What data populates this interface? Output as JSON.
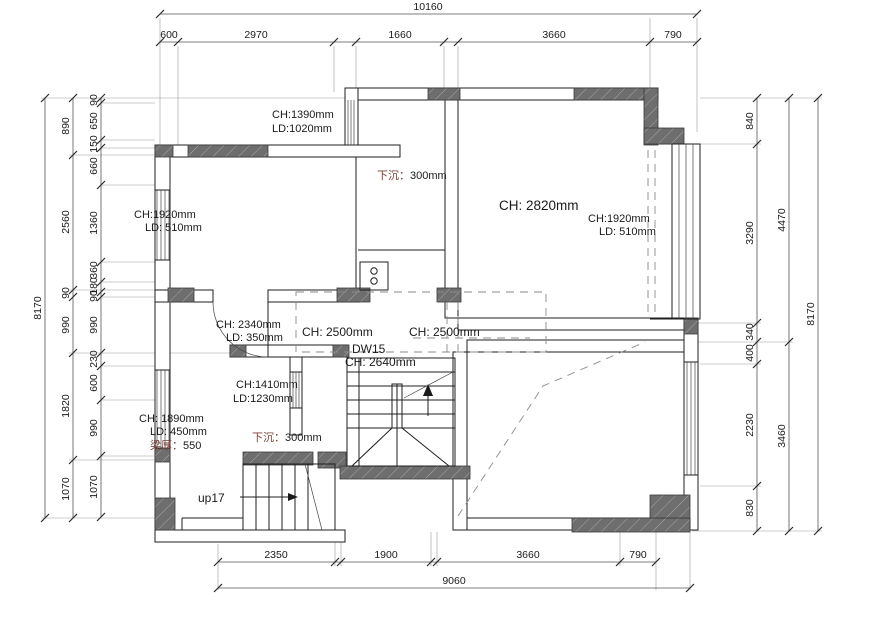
{
  "app": {
    "type": "cad-floor-plan",
    "background": "#ffffff",
    "line_color": "#1f1f1f",
    "wall_fill": "#6e6e6e",
    "hatch_color": "#a8a8a8",
    "cjk_text_color": "#7d4038"
  },
  "dims": {
    "top": {
      "total": "10160",
      "segs": [
        "600",
        "2970",
        "1660",
        "3660",
        "790"
      ]
    },
    "bottom": {
      "total": "9060",
      "segs": [
        "2350",
        "1900",
        "3660",
        "790"
      ]
    },
    "left": {
      "total": "8170",
      "mid": [
        "890",
        "2560",
        "90",
        "990",
        "1820",
        "1070"
      ],
      "inner": [
        "90",
        "650",
        "150",
        "660",
        "1360",
        "360",
        "180",
        "90",
        "990",
        "230",
        "600",
        "990",
        "1070"
      ]
    },
    "right": {
      "total": "8170",
      "mid": [
        "4470",
        "3460"
      ],
      "inner": [
        "840",
        "3290",
        "340",
        "400",
        "2230",
        "830"
      ]
    }
  },
  "labels": {
    "window_tl": {
      "ch": "CH:1390mm",
      "ld": "LD:1020mm"
    },
    "sunken_top": {
      "zh": "下沉：",
      "val": "300mm"
    },
    "living": {
      "ch": "CH: 2820mm"
    },
    "window_right": {
      "ch": "CH:1920mm",
      "ld": "LD: 510mm"
    },
    "window_left": {
      "ch": "CH:1920mm",
      "ld": "LD: 510mm"
    },
    "door_mid": {
      "ch": "CH: 2340mm",
      "ld": "LD: 350mm"
    },
    "hall_a": "CH: 2500mm",
    "hall_b": "CH: 2500mm",
    "dw15": "DW15",
    "stair_ch": "CH: 2640mm",
    "window_small": {
      "ch": "CH:1410mm",
      "ld": "LD:1230mm"
    },
    "room_bl": {
      "ch": "CH: 1890mm",
      "ld": "LD: 450mm",
      "beam_zh": "梁厚：",
      "beam_val": "550"
    },
    "sunken_bottom": {
      "zh": "下沉：",
      "val": "300mm"
    },
    "up17": "up17"
  }
}
